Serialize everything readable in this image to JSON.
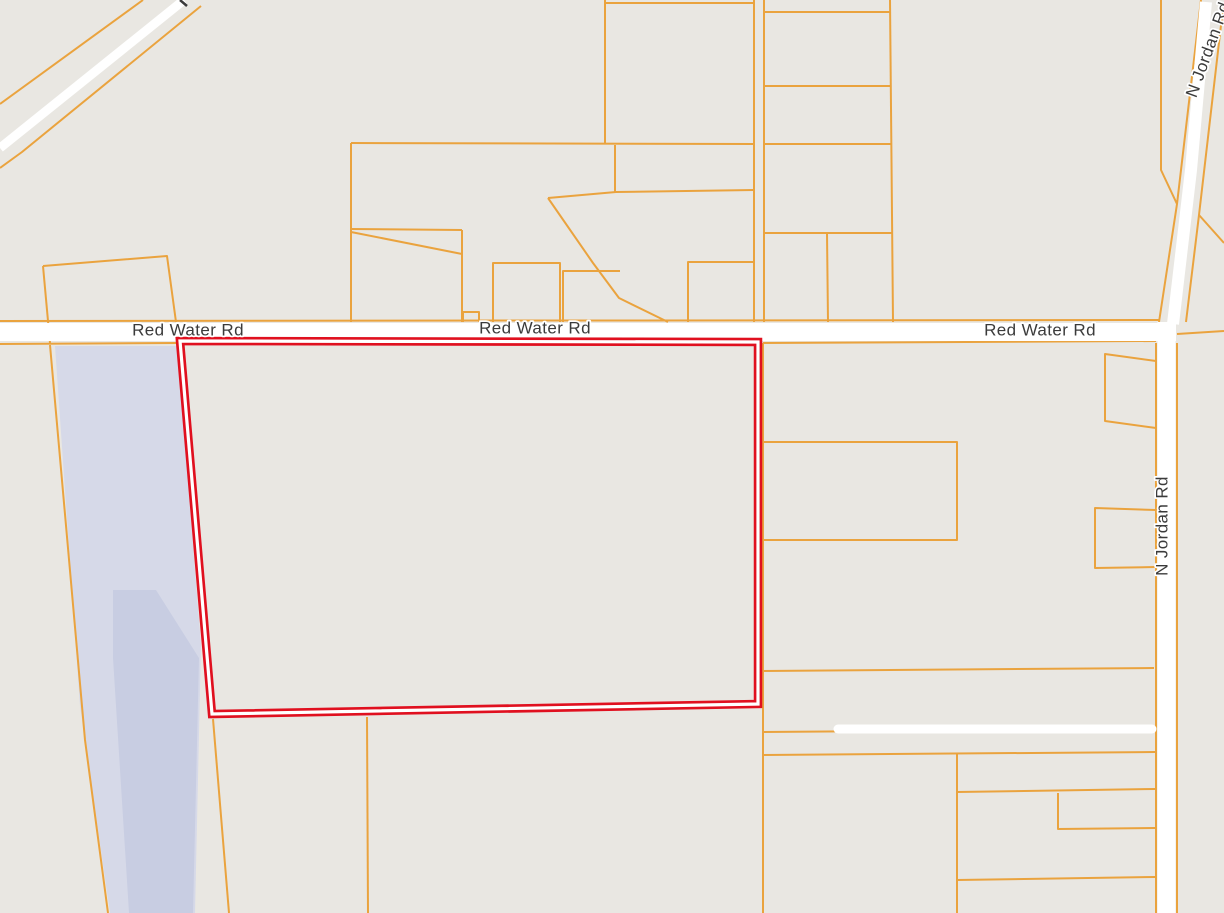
{
  "map": {
    "labels": {
      "red_water_rd_west": "Red Water Rd",
      "red_water_rd_center": "Red Water Rd",
      "red_water_rd_east": "Red Water Rd",
      "n_jordan_rd": "N Jordan Rd",
      "n_jordan_rd_top": "N Jordan Rd"
    },
    "colors": {
      "background": "#e9e7e2",
      "parcel_line": "#eaa33e",
      "road_fill": "#ffffff",
      "water": "#d6d9e8",
      "water_dark": "#c8cde2",
      "selected_parcel": "#e0101f",
      "selected_parcel_gap": "#ffffff",
      "label_text": "#3b3b3b",
      "label_halo": "#ffffff"
    }
  }
}
